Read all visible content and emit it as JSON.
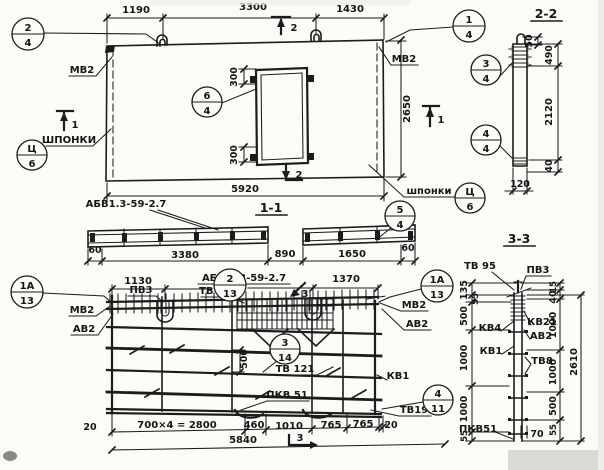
{
  "drawing": {
    "ink": "#1c1c1c",
    "paper": "#fcfbf8"
  },
  "elevation": {
    "dim_1190": "1190",
    "dim_3300": "3300",
    "dim_1430": "1430",
    "dim_5920": "5920",
    "dim_2650": "2650",
    "dim_300_top": "300",
    "dim_300_bottom": "300",
    "label_mv2_left": "МВ2",
    "label_mv2_right": "МВ2",
    "label_shponki_left": "ШПОНКИ",
    "label_shponki_right": "шпонки",
    "mark_1_left": "1",
    "mark_1_right": "1",
    "mark_2_top": "2",
    "mark_2_bottom": "2"
  },
  "section_1_1": {
    "title": "1-1",
    "series_label": "АБВ1.3-59-2.7",
    "dim_60_left": "60",
    "dim_60_right": "60",
    "dim_3380": "3380",
    "dim_890": "890",
    "dim_1650": "1650"
  },
  "section_2_2": {
    "title": "2-2",
    "dim_50": "50",
    "dim_490": "490",
    "dim_2120": "2120",
    "dim_40": "40",
    "dim_120": "120"
  },
  "plan": {
    "dim_1130": "1130",
    "dim_1370": "1370",
    "series_label": "АБВ 1.3-59-2.7",
    "label_pv3": "ПВ3",
    "label_tv44": "ТВ 44",
    "label_mv2_left": "МВ2",
    "label_av2_left": "АВ2",
    "label_mv2_right": "МВ2",
    "label_av2_right": "АВ2",
    "dim_500": "500",
    "label_tv121": "ТВ 121",
    "label_kv1": "КВ1",
    "label_pkv51": "ПКВ 51",
    "label_tv19": "ТВ19",
    "mark_3_top": "3",
    "mark_3_bottom": "3",
    "dim_20_left": "20",
    "dim_700x4": "700×4 = 2800",
    "dim_460": "460",
    "dim_1010": "1010",
    "dim_765_a": "765",
    "dim_765_b": "765",
    "dim_20_right": "20",
    "dim_5840": "5840"
  },
  "section_3_3": {
    "title": "3-3",
    "label_tv95": "ТВ 95",
    "label_pv3": "ПВ3",
    "dims_left": [
      "135",
      "55",
      "500",
      "1000",
      "1000",
      "55"
    ],
    "label_kv4": "КВ4",
    "label_kv1": "КВ1",
    "label_pkv51": "ПКВ51",
    "dim_70": "70",
    "dims_right": [
      "15",
      "40",
      "1000",
      "1000",
      "500",
      "55"
    ],
    "label_kv21": "КВ21",
    "label_av2": "АВ2",
    "label_tv8": "ТВ8",
    "dim_2610": "2610"
  },
  "callouts": {
    "c2_4": {
      "num": "2",
      "sheet": "4"
    },
    "c1_4": {
      "num": "1",
      "sheet": "4"
    },
    "c6_4": {
      "num": "6",
      "sheet": "4"
    },
    "c5_4": {
      "num": "5",
      "sheet": "4"
    },
    "c3_4": {
      "num": "3",
      "sheet": "4"
    },
    "c4_4": {
      "num": "4",
      "sheet": "4"
    },
    "cc6_left": {
      "num": "Ц",
      "sheet": "6"
    },
    "cc6_right": {
      "num": "Ц",
      "sheet": "6"
    },
    "c2_13": {
      "num": "2",
      "sheet": "13"
    },
    "c1a_13_left": {
      "num": "1А",
      "sheet": "13"
    },
    "c1a_13_right": {
      "num": "1А",
      "sheet": "13"
    },
    "c3_14": {
      "num": "3",
      "sheet": "14"
    },
    "c4_11": {
      "num": "4",
      "sheet": "11"
    }
  }
}
